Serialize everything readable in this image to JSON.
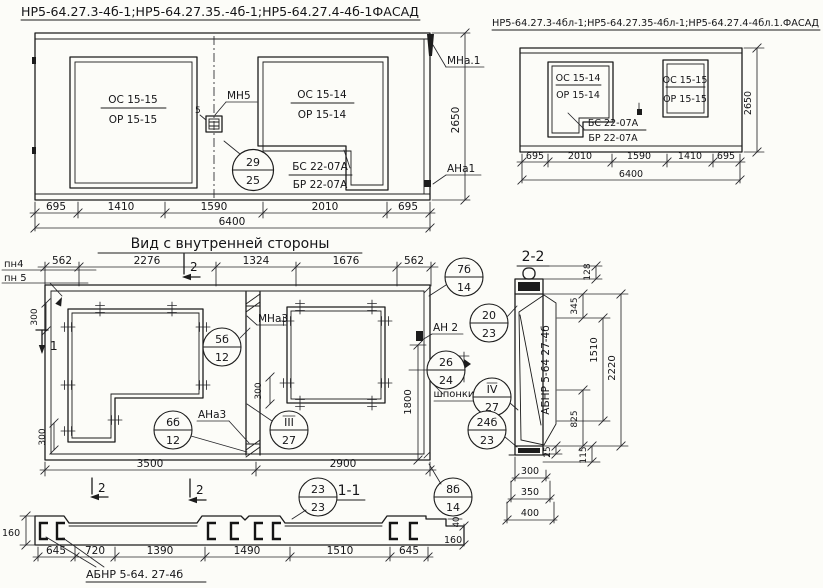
{
  "facade_left": {
    "title": "НР5-64.27.3-4б-1;НР5-64.27.35.-4б-1;НР5-64.27.4-4б-1ФАСАД",
    "window1_top": "ОС 15-15",
    "window1_bottom": "ОР 15-15",
    "window2_top": "ОС 15-14",
    "window2_bottom": "ОР 15-14",
    "corner_top": "БС 22-07А",
    "corner_bottom": "БР 22-07А",
    "callout_mn5": "МН5",
    "callout_mna1": "МНа.1",
    "callout_ana1": "АНа1",
    "dim_5": "5",
    "dims_bottom": [
      "695",
      "1410",
      "1590",
      "2010",
      "695"
    ],
    "dim_total": "6400",
    "dim_height": "2650"
  },
  "facade_right": {
    "title": "НР5-64.27.3-4бл-1;НР5-64.27.35-4бл-1;НР5-64.27.4-4бл.1.ФАСАД",
    "window1_top": "ОС 15-14",
    "window1_bottom": "ОР 15-14",
    "window2_top": "ОС 15-15",
    "window2_bottom": "ОР 15-15",
    "corner_top": "БС 22-07А",
    "corner_bottom": "БР 22-07А",
    "dims_bottom": [
      "695",
      "2010",
      "1590",
      "1410",
      "695"
    ],
    "dim_total": "6400",
    "dim_height": "2650"
  },
  "inner_view": {
    "title": "Вид с внутренней стороны",
    "dims_top": [
      "562",
      "2276",
      "1324",
      "1676",
      "562"
    ],
    "dims_bottom": [
      "3500",
      "2900"
    ],
    "label_pn4": "пн4",
    "label_pn5": "пн 5",
    "callout_mna3": "МНа3",
    "callout_ana3": "АНа3",
    "callout_an2": "АН 2",
    "label_shponki": "шпонки",
    "dim_300a": "300",
    "dim_300b": "300",
    "dim_300c": "300",
    "dim_1800": "1800",
    "marker_1": "1",
    "marker_2_top": "2",
    "marker_2_bottom": "2"
  },
  "section_2_2": {
    "title": "2-2",
    "label_unit": "АБНР 5-64 27-4б",
    "dim_128": "128",
    "dim_345": "345",
    "dim_1510": "1510",
    "dim_2220": "2220",
    "dim_825": "825",
    "dim_25": "25",
    "dim_115": "115",
    "dims_width": [
      "300",
      "350",
      "400"
    ]
  },
  "section_1_1": {
    "title": "1-1",
    "label_unit": "АБНР 5-64. 27-4б",
    "dims_bottom": [
      "645",
      "720",
      "1390",
      "1490",
      "1510",
      "645"
    ],
    "dim_160_left": "160",
    "dim_160_right": "160",
    "dim_40": "40",
    "marker_2": "2"
  },
  "balloons": {
    "b29_25": {
      "top": "29",
      "bottom": "25"
    },
    "b5b_12": {
      "top": "5б",
      "bottom": "12"
    },
    "b6b_12": {
      "top": "6б",
      "bottom": "12"
    },
    "b7b_14": {
      "top": "7б",
      "bottom": "14"
    },
    "b8b_14": {
      "top": "8б",
      "bottom": "14"
    },
    "b20_23": {
      "top": "20",
      "bottom": "23"
    },
    "b23_23": {
      "top": "23",
      "bottom": "23"
    },
    "b24b_23": {
      "top": "24б",
      "bottom": "23"
    },
    "b26_24": {
      "top": "26",
      "bottom": "24"
    },
    "bIII_27": {
      "top": "III",
      "bottom": "27"
    },
    "bIV_27": {
      "top": "IV",
      "bottom": "27"
    }
  },
  "colors": {
    "ink": "#1c1c1c",
    "paper": "#fcfcf8"
  }
}
